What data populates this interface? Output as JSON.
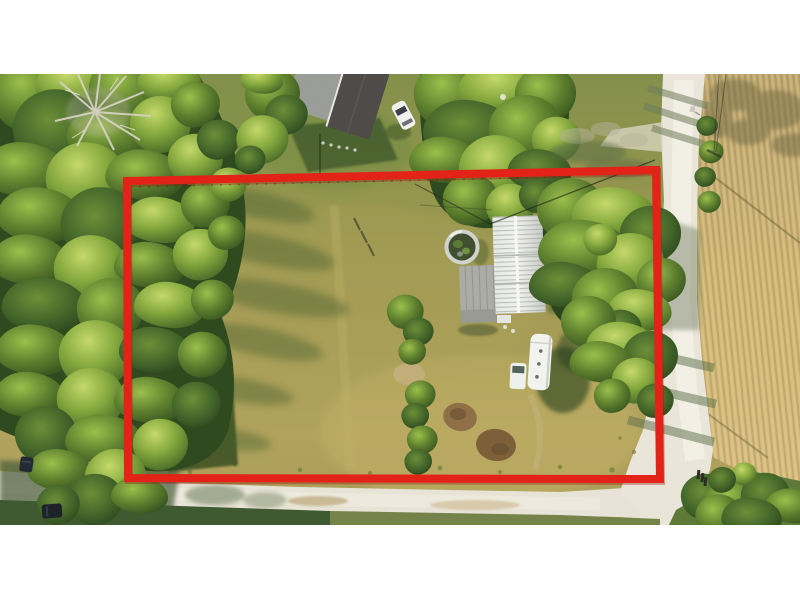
{
  "title": "Aerial drone photo of rural property with red parcel outline",
  "photo": {
    "type": "drone-aerial-top-down",
    "description": "Top-down aerial photo of a grassy rural lot outlined in red, with a white metal-roofed mobile home, round tank, RV trailer, woods on the left, dirt roads at bottom and right, and a plowed crop field on the right",
    "letterbox_color": "#ffffff",
    "area": {
      "x": 0,
      "y": 74,
      "width": 800,
      "height": 451
    }
  },
  "parcel_boundary": {
    "shape": "polygon",
    "color": "#e42318",
    "stroke_width": 8,
    "points": "127,181 656,170 660,479 128,478"
  },
  "palette": {
    "grass_sunlit": "#a89c57",
    "grass_golden": "#c4b165",
    "grass_shadow": "#46602e",
    "tree_dark": "#35521f",
    "tree_mid": "#5d7f2e",
    "tree_highlight": "#b4cf5e",
    "dead_tree": "#d8d3c4",
    "road_light": "#e9e5d8",
    "road_bright": "#f4f2ea",
    "field_tan": "#cfb376",
    "house_roof": "#eceeea",
    "barn_roof_dark": "#4e4b48",
    "barn_roof_light": "#9b9d99",
    "rv_white": "#f2f3ef",
    "vehicle_dark": "#232a31"
  },
  "scene_objects": [
    {
      "name": "mobile-home",
      "desc": "white ribbed metal roof, long axis north-south, center of parcel"
    },
    {
      "name": "porch-deck",
      "desc": "gray wooden deck attached to west side of home"
    },
    {
      "name": "round-tank",
      "desc": "round above-ground tank/planter with dark overgrown interior, west of home"
    },
    {
      "name": "rv-trailer",
      "desc": "white travel trailer parked south of home"
    },
    {
      "name": "utility-cart",
      "desc": "small white cart beside RV"
    },
    {
      "name": "farm-building",
      "desc": "two-tone gray roofed building outside parcel, top center"
    },
    {
      "name": "white-suv",
      "desc": "white SUV parked near top of parcel"
    },
    {
      "name": "dark-cars",
      "desc": "two dark vehicles on bottom road, lower left"
    },
    {
      "name": "mailbox-posts",
      "desc": "posts at road intersection, lower right"
    },
    {
      "name": "dirt-road-right",
      "desc": "white dirt road running north-south along east side"
    },
    {
      "name": "dirt-road-bottom",
      "desc": "dirt road running east-west along south side"
    },
    {
      "name": "crop-field",
      "desc": "golden plowed field with row striations, east of road"
    },
    {
      "name": "woods",
      "desc": "dense tree canopy along west side"
    },
    {
      "name": "dead-tree",
      "desc": "bare silvery dead tree in woods, upper left"
    },
    {
      "name": "garden-beds",
      "desc": "brown dirt garden patches, lower center of parcel"
    },
    {
      "name": "overgrown-fence-row",
      "desc": "line of bushes running north-south mid-parcel"
    }
  ]
}
